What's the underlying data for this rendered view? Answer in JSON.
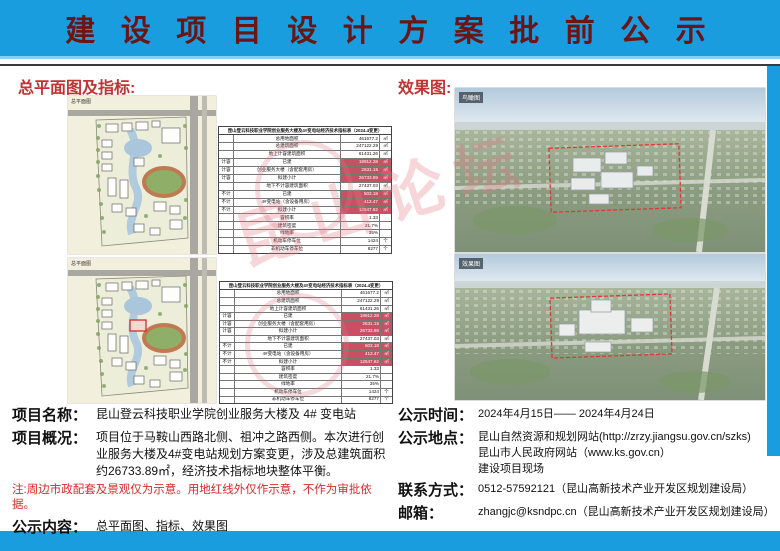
{
  "header": {
    "title": "建 设 项 目 设 计 方 案 批 前 公 示"
  },
  "colors": {
    "banner_blue": "#1a9ddf",
    "title_dark_red": "#6b1515",
    "section_heading_red": "#c23232",
    "note_red": "#d92a2a",
    "table_highlight": "#c94f62"
  },
  "sections": {
    "left_heading": "总平面图及指标:",
    "right_heading": "效果图:"
  },
  "plans": [
    {
      "caption": "总平面图"
    },
    {
      "caption": "总平面图"
    }
  ],
  "renders": [
    {
      "caption": "鸟瞰图"
    },
    {
      "caption": "效果图"
    }
  ],
  "table": {
    "title": "昆山登云科技职业学院创业服务大楼及4#变电站经济技术指标表（2024.4变更）",
    "rows": [
      {
        "group": "",
        "name": "总用地面积",
        "value": "461677.2",
        "unit": "㎡",
        "hl": false
      },
      {
        "group": "",
        "name": "总建筑面积",
        "value": "247122.29",
        "unit": "㎡",
        "hl": false
      },
      {
        "group": "",
        "name": "地上计容建筑面积",
        "value": "61431.26",
        "unit": "㎡",
        "hl": false
      },
      {
        "group": "计容",
        "name": "已建",
        "value": "18912.28",
        "unit": "㎡",
        "hl": true
      },
      {
        "group": "计容",
        "name": "创业服务大楼（含配套用房）",
        "value": "2631.15",
        "unit": "㎡",
        "hl": true
      },
      {
        "group": "计容",
        "name": "拟建小计",
        "value": "26733.89",
        "unit": "㎡",
        "hl": true
      },
      {
        "group": "",
        "name": "地下不计容建筑面积",
        "value": "27437.03",
        "unit": "㎡",
        "hl": false
      },
      {
        "group": "不计",
        "name": "已建",
        "value": "503.18",
        "unit": "㎡",
        "hl": true
      },
      {
        "group": "不计",
        "name": "4#变电站（含设备用房）",
        "value": "413.47",
        "unit": "㎡",
        "hl": true
      },
      {
        "group": "不计",
        "name": "拟建小计",
        "value": "12547.62",
        "unit": "㎡",
        "hl": true
      },
      {
        "group": "",
        "name": "容积率",
        "value": "1.33",
        "unit": "",
        "hl": false
      },
      {
        "group": "",
        "name": "建筑密度",
        "value": "21.7%",
        "unit": "",
        "hl": false
      },
      {
        "group": "",
        "name": "绿地率",
        "value": "35%",
        "unit": "",
        "hl": false
      },
      {
        "group": "",
        "name": "机动车停车位",
        "value": "1424",
        "unit": "个",
        "hl": false
      },
      {
        "group": "",
        "name": "非机动车停车位",
        "value": "8277",
        "unit": "个",
        "hl": false
      }
    ]
  },
  "watermark": {
    "text": "昆山论坛"
  },
  "info": {
    "name_label": "项目名称：",
    "name_value": "昆山登云科技职业学院创业服务大楼及 4# 变电站",
    "overview_label": "项目概况：",
    "overview_value": "项目位于马鞍山西路北侧、祖冲之路西侧。本次进行创业服务大楼及4#变电站规划方案变更，涉及总建筑面积约26733.89㎡，经济技术指标地块整体平衡。",
    "note": "注:周边市政配套及景观仅为示意。用地红线外仅作示意，不作为审批依据。",
    "content_label": "公示内容：",
    "content_value": "总平面图、指标、效果图",
    "time_label": "公示时间：",
    "time_value": "2024年4月15日—— 2024年4月24日",
    "place_label": "公示地点：",
    "place_value": "昆山自然资源和规划网站(http://zrzy.jiangsu.gov.cn/szks)\n昆山市人民政府网站（www.ks.gov.cn）\n建设项目现场",
    "contact_label": "联系方式：",
    "contact_value": "0512-57592121（昆山高新技术产业开发区规划建设局）",
    "email_label": "邮箱：",
    "email_value": "zhangjc@ksndpc.cn（昆山高新技术产业开发区规划建设局）"
  }
}
